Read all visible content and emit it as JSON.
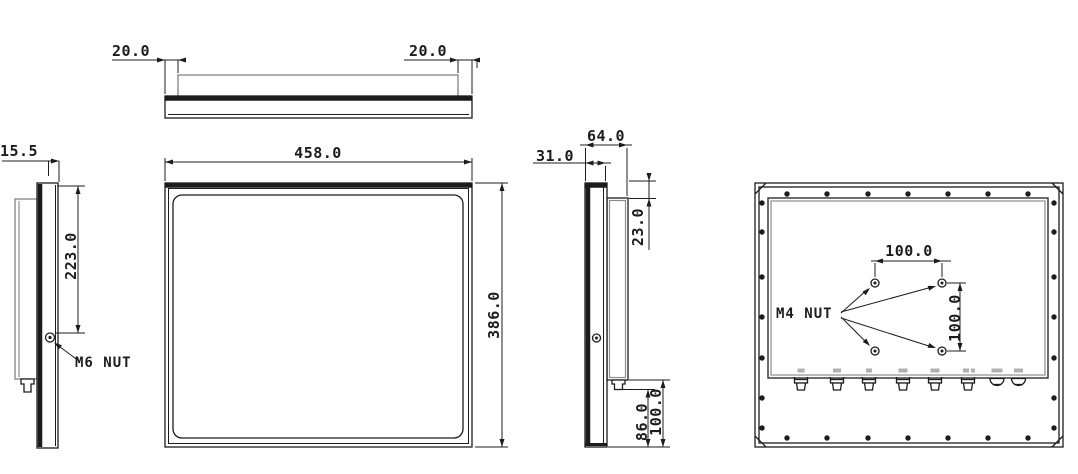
{
  "colors": {
    "line": "#1c1c1c",
    "secondary": "#8c8c8c",
    "connector_label": "#b0b0b0",
    "background": "#ffffff"
  },
  "views": {
    "top": {
      "dim_left": "20.0",
      "dim_right": "20.0"
    },
    "left_side": {
      "thickness": "15.5",
      "nut_offset": "223.0",
      "nut_callout": "M6 NUT"
    },
    "front": {
      "width": "458.0",
      "height": "386.0"
    },
    "right_side": {
      "total_depth": "64.0",
      "front_depth": "31.0",
      "top_inset": "23.0",
      "bottom_inset": "86.0",
      "bottom_total": "100.0"
    },
    "rear": {
      "nut_callout": "M4 NUT",
      "vesa_width": "100.0",
      "vesa_height": "100.0"
    }
  }
}
